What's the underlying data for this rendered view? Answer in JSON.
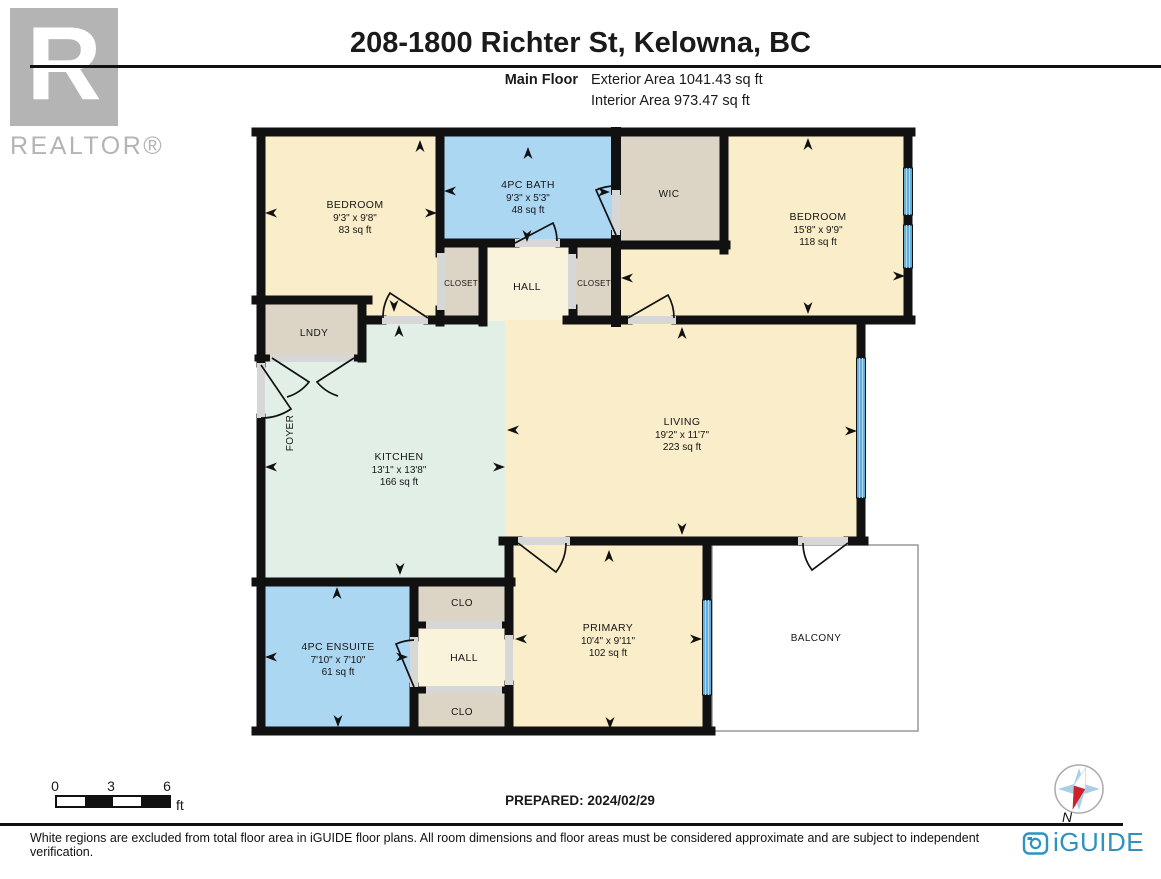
{
  "header": {
    "title": "208-1800 Richter St, Kelowna, BC",
    "floor_label": "Main Floor",
    "exterior_area": "Exterior Area 1041.43 sq ft",
    "interior_area": "Interior Area 973.47 sq ft"
  },
  "branding": {
    "realtor_letter": "R",
    "realtor_word": "REALTOR®",
    "iguide_text": "iGUIDE",
    "compass_north": "N"
  },
  "rooms": {
    "bedroom1": {
      "label": "BEDROOM",
      "dims": "9'3\" x 9'8\"",
      "area": "83 sq ft"
    },
    "bath": {
      "label": "4PC BATH",
      "dims": "9'3\" x 5'3\"",
      "area": "48 sq ft"
    },
    "wic": {
      "label": "WIC"
    },
    "bedroom2": {
      "label": "BEDROOM",
      "dims": "15'8\" x 9'9\"",
      "area": "118 sq ft"
    },
    "closet_left": {
      "label": "CLOSET"
    },
    "hall_top": {
      "label": "HALL"
    },
    "closet_right": {
      "label": "CLOSET"
    },
    "lndy": {
      "label": "LNDY"
    },
    "foyer": {
      "label": "FOYER"
    },
    "kitchen": {
      "label": "KITCHEN",
      "dims": "13'1\" x 13'8\"",
      "area": "166 sq ft"
    },
    "living": {
      "label": "LIVING",
      "dims": "19'2\" x 11'7\"",
      "area": "223 sq ft"
    },
    "ensuite": {
      "label": "4PC ENSUITE",
      "dims": "7'10\" x 7'10\"",
      "area": "61 sq ft"
    },
    "clo_top": {
      "label": "CLO"
    },
    "hall_bottom": {
      "label": "HALL"
    },
    "clo_bottom": {
      "label": "CLO"
    },
    "primary": {
      "label": "PRIMARY",
      "dims": "10'4\" x 9'11\"",
      "area": "102 sq ft"
    },
    "balcony": {
      "label": "BALCONY"
    }
  },
  "scale_bar": {
    "ticks": [
      "0",
      "3",
      "6"
    ],
    "unit": "ft"
  },
  "footer": {
    "prepared": "PREPARED: 2024/02/29",
    "disclaimer": "White regions are excluded from total floor area in iGUIDE floor plans. All room dimensions and floor areas must be considered approximate and are subject to independent verification."
  },
  "colors": {
    "wall": "#111111",
    "room_cream": "#faedc9",
    "hall_cream": "#faf3dc",
    "room_blue": "#abd7f2",
    "room_green": "#e2efe7",
    "room_tan": "#dcd4c5",
    "door_sill": "#d7d7d7",
    "window_blue": "#64aedc",
    "iguide_blue": "#2e93be",
    "realtor_gray": "#b4b4b4"
  }
}
